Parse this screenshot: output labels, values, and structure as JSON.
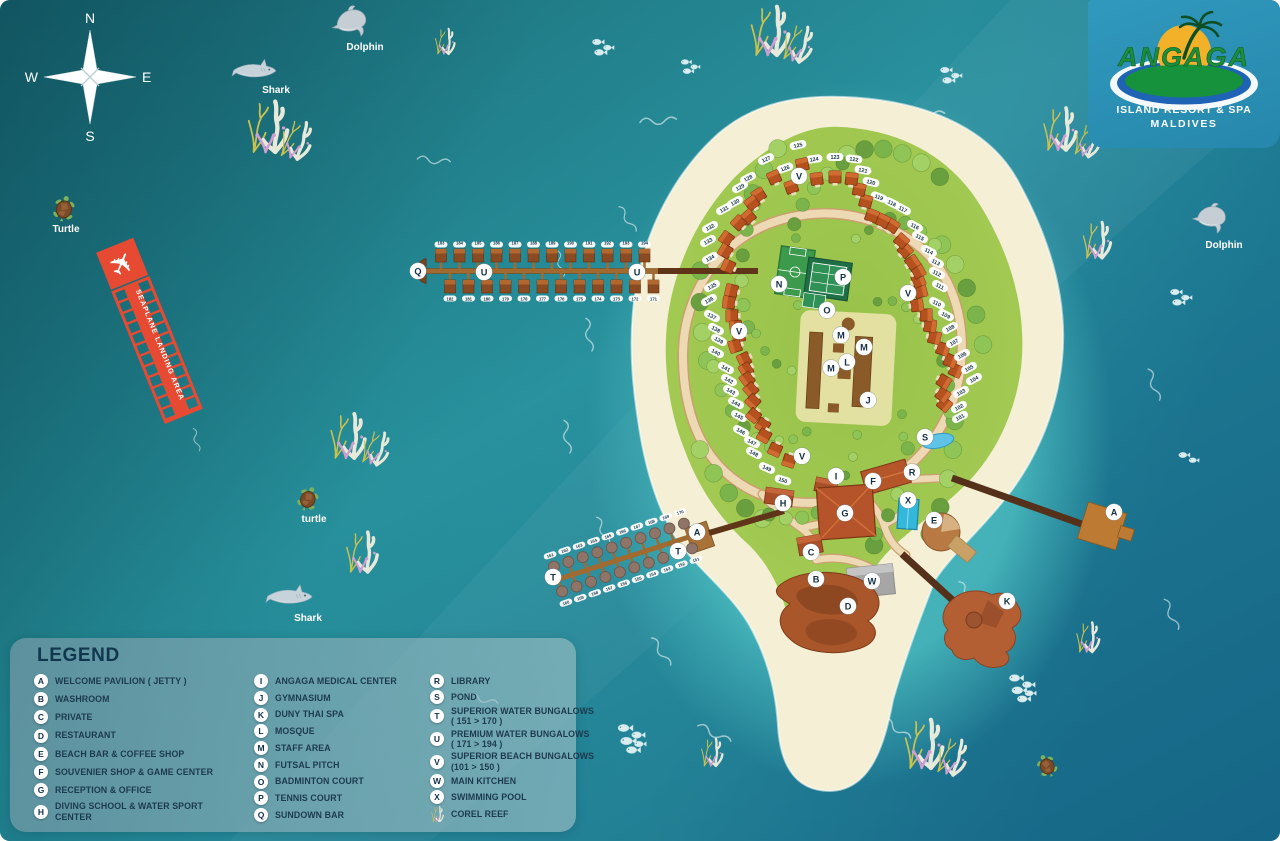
{
  "logo": {
    "name": "ANGAGA",
    "line1": "ISLAND RESORT & SPA",
    "line2": "MALDIVES"
  },
  "compass": {
    "n": "N",
    "e": "E",
    "s": "S",
    "w": "W"
  },
  "seaplane": {
    "label": "SEAPLANE LANDING AREA"
  },
  "legend": {
    "title": "LEGEND",
    "columns": [
      {
        "items": [
          {
            "k": "A",
            "l": "WELCOME PAVILION ( JETTY )"
          },
          {
            "k": "B",
            "l": "WASHROOM"
          },
          {
            "k": "C",
            "l": "PRIVATE"
          },
          {
            "k": "D",
            "l": "RESTAURANT"
          },
          {
            "k": "E",
            "l": "BEACH BAR & COFFEE SHOP"
          },
          {
            "k": "F",
            "l": "SOUVENIER SHOP & GAME CENTER"
          },
          {
            "k": "G",
            "l": "RECEPTION & OFFICE"
          },
          {
            "k": "H",
            "l": "DIVING SCHOOL & WATER SPORT CENTER"
          }
        ]
      },
      {
        "items": [
          {
            "k": "I",
            "l": "ANGAGA MEDICAL CENTER"
          },
          {
            "k": "J",
            "l": "GYMNASIUM"
          },
          {
            "k": "K",
            "l": "DUNY THAI SPA"
          },
          {
            "k": "L",
            "l": "MOSQUE"
          },
          {
            "k": "M",
            "l": "STAFF AREA"
          },
          {
            "k": "N",
            "l": "FUTSAL PITCH"
          },
          {
            "k": "O",
            "l": "BADMINTON COURT"
          },
          {
            "k": "P",
            "l": "TENNIS COURT"
          },
          {
            "k": "Q",
            "l": "SUNDOWN BAR"
          }
        ]
      },
      {
        "items": [
          {
            "k": "R",
            "l": "LIBRARY"
          },
          {
            "k": "S",
            "l": "POND"
          },
          {
            "k": "T",
            "l": "SUPERIOR WATER BUNGALOWS",
            "l2": "( 151 > 170 )"
          },
          {
            "k": "U",
            "l": "PREMIUM WATER BUNGALOWS",
            "l2": "( 171 > 194 )"
          },
          {
            "k": "V",
            "l": "SUPERIOR BEACH BUNGALOWS",
            "l2": "(101 > 150 )"
          },
          {
            "k": "W",
            "l": "MAIN KITCHEN"
          },
          {
            "k": "X",
            "l": "SWIMMING POOL"
          },
          {
            "icon": "coral",
            "l": "COREL REEF"
          }
        ]
      }
    ]
  },
  "sea_life": {
    "items": [
      {
        "type": "dolphin",
        "x": 352,
        "y": 22,
        "s": 1,
        "r": -8,
        "label": "Dolphin",
        "lx": 365,
        "ly": 50
      },
      {
        "type": "dolphin",
        "x": 1212,
        "y": 218,
        "s": 0.95,
        "r": 6,
        "label": "Dolphin",
        "lx": 1224,
        "ly": 248
      },
      {
        "type": "shark",
        "x": 255,
        "y": 70,
        "s": 0.95,
        "r": 0,
        "label": "Shark",
        "lx": 276,
        "ly": 93
      },
      {
        "type": "shark",
        "x": 290,
        "y": 596,
        "s": 1,
        "r": 0,
        "label": "Shark",
        "lx": 308,
        "ly": 621
      },
      {
        "type": "turtle",
        "x": 64,
        "y": 209,
        "s": 1,
        "r": 12,
        "label": "Turtle",
        "lx": 66,
        "ly": 232
      },
      {
        "type": "turtle",
        "x": 308,
        "y": 499,
        "s": 0.95,
        "r": 22,
        "label": "turtle",
        "lx": 314,
        "ly": 522
      },
      {
        "type": "turtle",
        "x": 1047,
        "y": 766,
        "s": 0.9,
        "r": -25
      },
      {
        "type": "fish",
        "x": 598,
        "y": 42,
        "s": 0.8,
        "n": 3
      },
      {
        "type": "fish",
        "x": 686,
        "y": 62,
        "s": 0.7,
        "n": 3
      },
      {
        "type": "fish",
        "x": 946,
        "y": 70,
        "s": 0.8,
        "n": 3
      },
      {
        "type": "fish",
        "x": 1176,
        "y": 292,
        "s": 0.8,
        "n": 3
      },
      {
        "type": "fish",
        "x": 1184,
        "y": 455,
        "s": 0.75,
        "n": 2
      },
      {
        "type": "fish",
        "x": 625,
        "y": 728,
        "s": 1,
        "n": 5
      },
      {
        "type": "fish",
        "x": 1016,
        "y": 678,
        "s": 0.95,
        "n": 5
      }
    ]
  },
  "map": {
    "markers": [
      {
        "l": "A",
        "x": 697,
        "y": 532
      },
      {
        "l": "A",
        "x": 1114,
        "y": 512
      },
      {
        "l": "B",
        "x": 816,
        "y": 579
      },
      {
        "l": "C",
        "x": 811,
        "y": 552
      },
      {
        "l": "D",
        "x": 848,
        "y": 606
      },
      {
        "l": "E",
        "x": 934,
        "y": 520
      },
      {
        "l": "F",
        "x": 873,
        "y": 481
      },
      {
        "l": "G",
        "x": 845,
        "y": 513
      },
      {
        "l": "H",
        "x": 783,
        "y": 503
      },
      {
        "l": "I",
        "x": 836,
        "y": 476
      },
      {
        "l": "J",
        "x": 868,
        "y": 400
      },
      {
        "l": "K",
        "x": 1007,
        "y": 601
      },
      {
        "l": "L",
        "x": 847,
        "y": 362
      },
      {
        "l": "M",
        "x": 841,
        "y": 335
      },
      {
        "l": "M",
        "x": 864,
        "y": 347
      },
      {
        "l": "M",
        "x": 831,
        "y": 368
      },
      {
        "l": "N",
        "x": 779,
        "y": 284
      },
      {
        "l": "O",
        "x": 827,
        "y": 310
      },
      {
        "l": "P",
        "x": 843,
        "y": 277
      },
      {
        "l": "Q",
        "x": 418,
        "y": 271
      },
      {
        "l": "R",
        "x": 912,
        "y": 472
      },
      {
        "l": "S",
        "x": 925,
        "y": 437
      },
      {
        "l": "T",
        "x": 553,
        "y": 577
      },
      {
        "l": "T",
        "x": 678,
        "y": 551
      },
      {
        "l": "U",
        "x": 484,
        "y": 272
      },
      {
        "l": "U",
        "x": 637,
        "y": 272
      },
      {
        "l": "V",
        "x": 799,
        "y": 176
      },
      {
        "l": "V",
        "x": 908,
        "y": 293
      },
      {
        "l": "V",
        "x": 739,
        "y": 331
      },
      {
        "l": "V",
        "x": 802,
        "y": 456
      },
      {
        "l": "W",
        "x": 872,
        "y": 581
      },
      {
        "l": "X",
        "x": 908,
        "y": 500
      }
    ],
    "beach_bungalows": {
      "range": "101-150",
      "units": [
        [
          101,
          960,
          417
        ],
        [
          102,
          959,
          407
        ],
        [
          103,
          961,
          392
        ],
        [
          104,
          974,
          379
        ],
        [
          105,
          969,
          368
        ],
        [
          106,
          962,
          355
        ],
        [
          107,
          954,
          342
        ],
        [
          108,
          950,
          328
        ],
        [
          109,
          946,
          315
        ],
        [
          110,
          937,
          303
        ],
        [
          111,
          940,
          286
        ],
        [
          112,
          937,
          273
        ],
        [
          113,
          936,
          262
        ],
        [
          114,
          929,
          251
        ],
        [
          115,
          920,
          237
        ],
        [
          116,
          915,
          226
        ],
        [
          117,
          903,
          209
        ],
        [
          118,
          892,
          203
        ],
        [
          119,
          879,
          197
        ],
        [
          120,
          871,
          182
        ],
        [
          121,
          863,
          170
        ],
        [
          122,
          854,
          159
        ],
        [
          123,
          835,
          157
        ],
        [
          124,
          814,
          159
        ],
        [
          125,
          798,
          145
        ],
        [
          126,
          785,
          168
        ],
        [
          127,
          766,
          159
        ],
        [
          128,
          748,
          178
        ],
        [
          129,
          740,
          187
        ],
        [
          130,
          735,
          202
        ],
        [
          131,
          724,
          209
        ],
        [
          132,
          710,
          227
        ],
        [
          133,
          708,
          241
        ],
        [
          134,
          710,
          258
        ],
        [
          135,
          712,
          286
        ],
        [
          136,
          709,
          300
        ],
        [
          137,
          712,
          316
        ],
        [
          138,
          716,
          329
        ],
        [
          139,
          719,
          340
        ],
        [
          140,
          716,
          352
        ],
        [
          141,
          726,
          368
        ],
        [
          142,
          729,
          380
        ],
        [
          143,
          731,
          391
        ],
        [
          144,
          736,
          403
        ],
        [
          145,
          739,
          416
        ],
        [
          146,
          741,
          431
        ],
        [
          147,
          752,
          442
        ],
        [
          148,
          754,
          453
        ],
        [
          149,
          767,
          468
        ],
        [
          150,
          783,
          480
        ]
      ]
    },
    "superior_water_bungalows": {
      "from": 151,
      "to": 170
    },
    "premium_water_bungalows": {
      "from": 171,
      "to": 194
    },
    "corals": [
      {
        "x": 268,
        "y": 152,
        "s": 1.2
      },
      {
        "x": 445,
        "y": 54,
        "s": 0.6
      },
      {
        "x": 770,
        "y": 55,
        "s": 1.15
      },
      {
        "x": 1060,
        "y": 150,
        "s": 1.0
      },
      {
        "x": 1097,
        "y": 258,
        "s": 0.85
      },
      {
        "x": 348,
        "y": 458,
        "s": 1.05
      },
      {
        "x": 362,
        "y": 572,
        "s": 0.95
      },
      {
        "x": 1088,
        "y": 652,
        "s": 0.7
      },
      {
        "x": 924,
        "y": 768,
        "s": 1.15
      },
      {
        "x": 712,
        "y": 766,
        "s": 0.65
      }
    ]
  },
  "colors": {
    "water_deep": "#176b77",
    "water_mid": "#27919c",
    "lagoon": "#48b8bc",
    "sand": "#f4efd5",
    "island_green": "#a3ca52",
    "pier_light": "#a06a30",
    "pier_dark": "#5f3418",
    "seaplane_red": "#e64a32",
    "marker_bg": "#ffffff",
    "marker_text": "#122e44",
    "legend_text": "#1d3a4d",
    "logo_panel": "#2e94ba"
  }
}
